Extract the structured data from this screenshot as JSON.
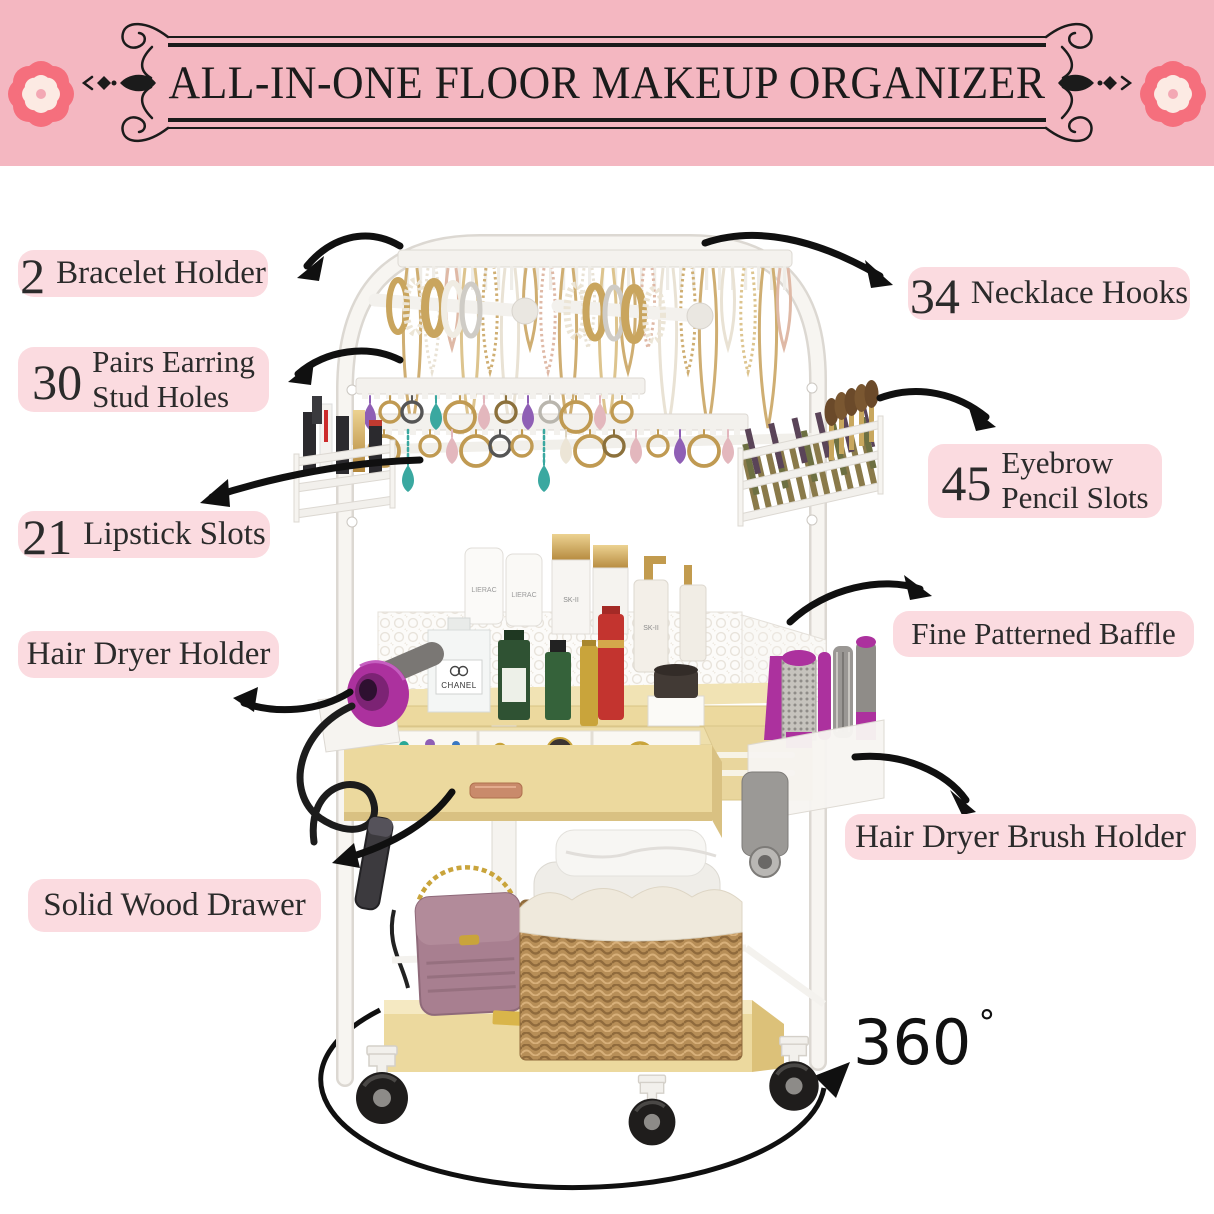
{
  "banner": {
    "title": "ALL-IN-ONE FLOOR MAKEUP ORGANIZER"
  },
  "feature_labels": {
    "bracelet_holder": {
      "number": "2",
      "text": "Bracelet Holder"
    },
    "earring_stud_holes": {
      "number": "30",
      "line1": "Pairs Earring",
      "line2": "Stud Holes"
    },
    "lipstick_slots": {
      "number": "21",
      "text": "Lipstick Slots"
    },
    "hair_dryer_holder": {
      "text": "Hair Dryer Holder"
    },
    "solid_wood_drawer": {
      "text": "Solid Wood Drawer"
    },
    "necklace_hooks": {
      "number": "34",
      "text": "Necklace Hooks"
    },
    "eyebrow_pencil_slots": {
      "number": "45",
      "line1": "Eyebrow",
      "line2": "Pencil Slots"
    },
    "fine_patterned_baffle": {
      "text": "Fine Patterned Baffle"
    },
    "hair_dryer_brush_holder": {
      "text": "Hair Dryer Brush Holder"
    }
  },
  "rotation_badge": {
    "value": "360",
    "unit": "°"
  },
  "product": {
    "brand_texts": {
      "perfume": "CHANEL",
      "tube": "LIERAC",
      "serum": "SK-II"
    }
  },
  "colors": {
    "banner_bg": "#f4b7c1",
    "label_bg": "#fbdbe0",
    "ink": "#2b2b2b",
    "arrow_black": "#101010",
    "frame_black": "#1b1b1b",
    "flower_outer": "#f56f7d",
    "flower_inner": "#fceae3",
    "wood": "#ecd99e",
    "accent_magenta": "#ac319e"
  }
}
